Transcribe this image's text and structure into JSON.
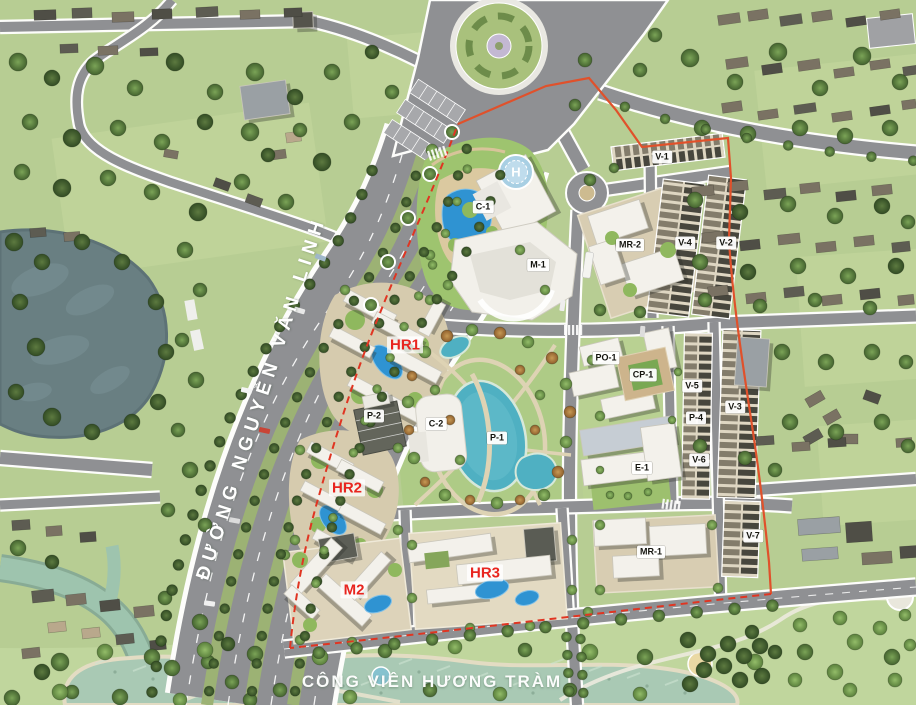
{
  "map": {
    "street_name": "ĐƯỜNG NGUYỄN VĂN LINH",
    "park_name": "CÔNG VIÊN HƯƠNG TRÀM",
    "helipad_letter": "H"
  },
  "plot_labels": [
    {
      "text": "C-1"
    },
    {
      "text": "M-1"
    },
    {
      "text": "MR-2"
    },
    {
      "text": "V-1"
    },
    {
      "text": "V-4"
    },
    {
      "text": "V-2"
    },
    {
      "text": "P-2"
    },
    {
      "text": "C-2"
    },
    {
      "text": "P-1"
    },
    {
      "text": "PO-1"
    },
    {
      "text": "CP-1"
    },
    {
      "text": "V-5"
    },
    {
      "text": "V-3"
    },
    {
      "text": "P-4"
    },
    {
      "text": "V-6"
    },
    {
      "text": "E-1"
    },
    {
      "text": "MR-1"
    },
    {
      "text": "V-7"
    }
  ],
  "highlight_labels": [
    {
      "text": "HR1"
    },
    {
      "text": "HR2"
    },
    {
      "text": "HR3"
    },
    {
      "text": "M2"
    }
  ],
  "colors": {
    "highlight_red": "#e8251f",
    "boundary_dashed": "#e03522",
    "boundary_solid": "#e0512b",
    "pond_water": "#4fb0c2",
    "pool_blue": "#2f93d2",
    "park_lake": "#a9c9b4",
    "left_lake": "#697f82",
    "asphalt": "#8f9093",
    "grass": "#b7cd93"
  }
}
